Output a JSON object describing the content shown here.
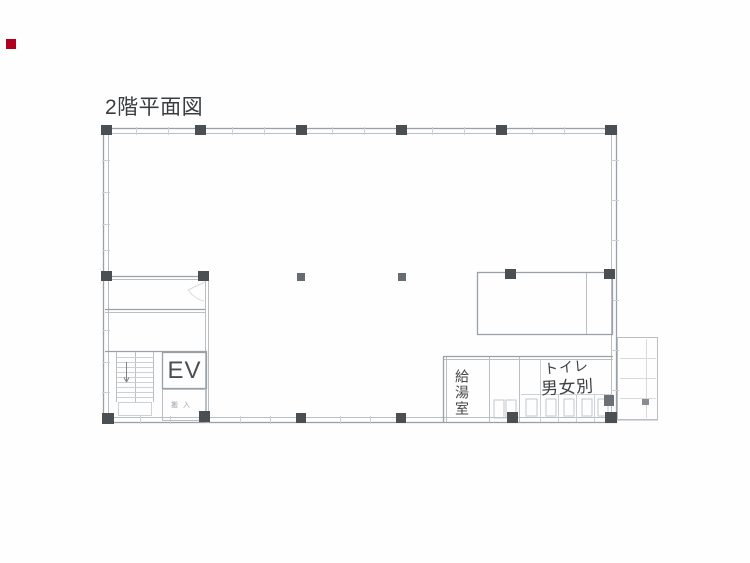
{
  "page": {
    "background": "#fefefe"
  },
  "marker": {
    "color": "#b00020"
  },
  "title": {
    "text": "2階平面図"
  },
  "plan": {
    "labels": {
      "elevator": "EV",
      "kitchenette": "給湯室",
      "toilet_line1": "トイレ",
      "toilet_line2": "男女別",
      "service_small": "搬入"
    },
    "colors": {
      "wall": "#9aa0a7",
      "wall_light": "#b9bfc5",
      "column": "#4a4f54",
      "text": "#3d4043",
      "marker_red": "#b00020"
    }
  }
}
